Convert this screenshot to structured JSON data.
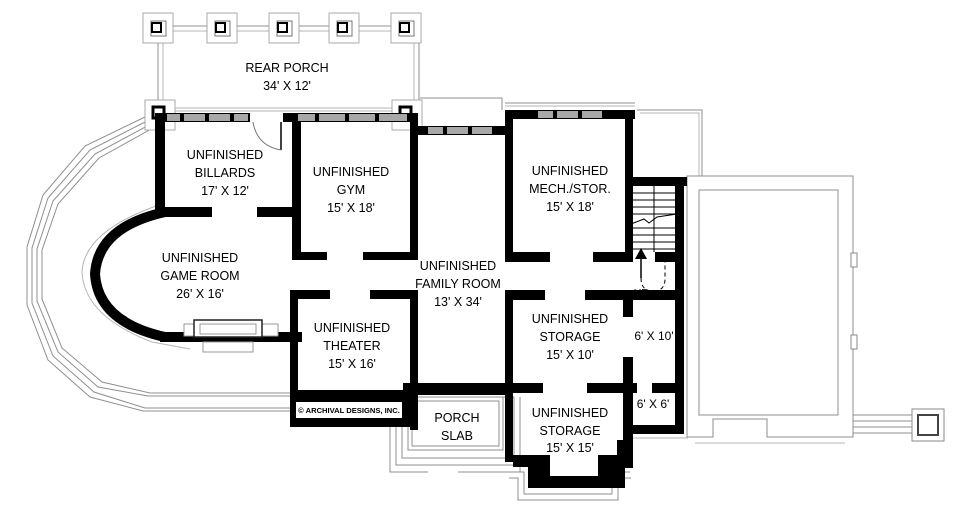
{
  "plan": {
    "rear_porch": {
      "name": "REAR PORCH",
      "dims": "34' X 12'"
    },
    "billiards": {
      "l1": "UNFINISHED",
      "l2": "BILLARDS",
      "dims": "17' X 12'"
    },
    "gym": {
      "l1": "UNFINISHED",
      "l2": "GYM",
      "dims": "15' X 18'"
    },
    "mech_stor": {
      "l1": "UNFINISHED",
      "l2": "MECH./STOR.",
      "dims": "15' X 18'"
    },
    "game_room": {
      "l1": "UNFINISHED",
      "l2": "GAME ROOM",
      "dims": "26' X 16'"
    },
    "family_room": {
      "l1": "UNFINISHED",
      "l2": "FAMILY ROOM",
      "dims": "13' X 34'"
    },
    "theater": {
      "l1": "UNFINISHED",
      "l2": "THEATER",
      "dims": "15' X 16'"
    },
    "storage_upper": {
      "l1": "UNFINISHED",
      "l2": "STORAGE",
      "dims": "15' X 10'"
    },
    "storage_lower": {
      "l1": "UNFINISHED",
      "l2": "STORAGE",
      "dims": "15' X 15'"
    },
    "room_6x10": {
      "dims": "6' X 10'"
    },
    "room_6x6": {
      "dims": "6' X 6'"
    },
    "porch_slab": {
      "l1": "PORCH",
      "l2": "SLAB"
    },
    "stairs": {
      "up_label": "UP"
    },
    "copyright": "© ARCHIVAL DESIGNS, INC."
  },
  "colors": {
    "wall": "#000000",
    "window_fill": "#a8a8a8",
    "outline": "#8f8f8f",
    "background": "#ffffff"
  }
}
